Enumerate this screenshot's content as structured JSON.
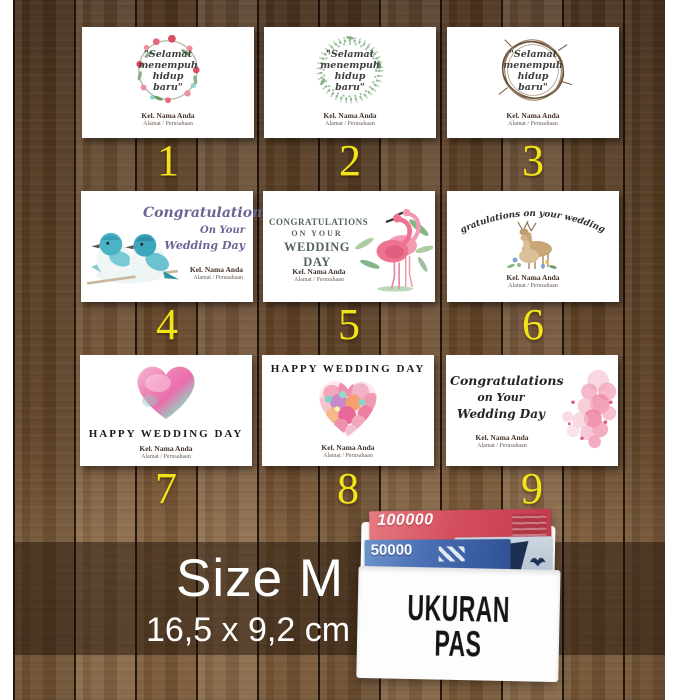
{
  "cards": [
    {
      "number": "1",
      "style": "floral-wreath",
      "quote": [
        "\"Selamat",
        "menempuh",
        "hidup",
        "baru\""
      ],
      "sender": "Kel. Nama Anda",
      "address": "Alamat / Perusahaan"
    },
    {
      "number": "2",
      "style": "leaf-wreath",
      "quote": [
        "\"Selamat",
        "menempuh",
        "hidup",
        "baru\""
      ],
      "sender": "Kel. Nama Anda",
      "address": "Alamat / Perusahaan"
    },
    {
      "number": "3",
      "style": "twig-wreath",
      "quote": [
        "\"Selamat",
        "menempuh",
        "hidup",
        "baru\""
      ],
      "sender": "Kel. Nama Anda",
      "address": "Alamat / Perusahaan"
    },
    {
      "number": "4",
      "style": "blue-birds",
      "title": [
        "Congratulations",
        "On Your",
        "Wedding Day"
      ],
      "sender": "Kel. Nama Anda",
      "address": "Alamat / Perusahaan"
    },
    {
      "number": "5",
      "style": "flamingos",
      "title": [
        "CONGRATULATIONS",
        "ON YOUR",
        "WEDDING DAY"
      ],
      "sender": "Kel. Nama Anda",
      "address": "Alamat / Perusahaan"
    },
    {
      "number": "6",
      "style": "deer-couple",
      "title": "Congratulations on your wedding day",
      "sender": "Kel. Nama Anda",
      "address": "Alamat / Perusahaan"
    },
    {
      "number": "7",
      "style": "watercolor-heart",
      "title": "HAPPY WEDDING DAY",
      "sender": "Kel. Nama Anda",
      "address": "Alamat / Perusahaan"
    },
    {
      "number": "8",
      "style": "floral-heart",
      "title": "HAPPY WEDDING DAY",
      "sender": "Kel. Nama Anda",
      "address": "Alamat / Perusahaan"
    },
    {
      "number": "9",
      "style": "pink-blossoms",
      "title": [
        "Congratulations",
        "on Your",
        "Wedding Day"
      ],
      "sender": "Kel. Nama Anda",
      "address": "Alamat / Perusahaan"
    }
  ],
  "footer": {
    "size_title": "Size M",
    "size_dimensions": "16,5 x 9,2 cm"
  },
  "envelope": {
    "label": [
      "UKURAN",
      "PAS"
    ],
    "banknotes": [
      {
        "value": "100000"
      },
      {
        "value": "50000"
      }
    ]
  },
  "colors": {
    "number_accent": "#f2e416",
    "banknote_100000": "#c9404f",
    "banknote_50000": "#3a62a8",
    "band_overlay": "rgba(22,10,3,0.45)"
  }
}
